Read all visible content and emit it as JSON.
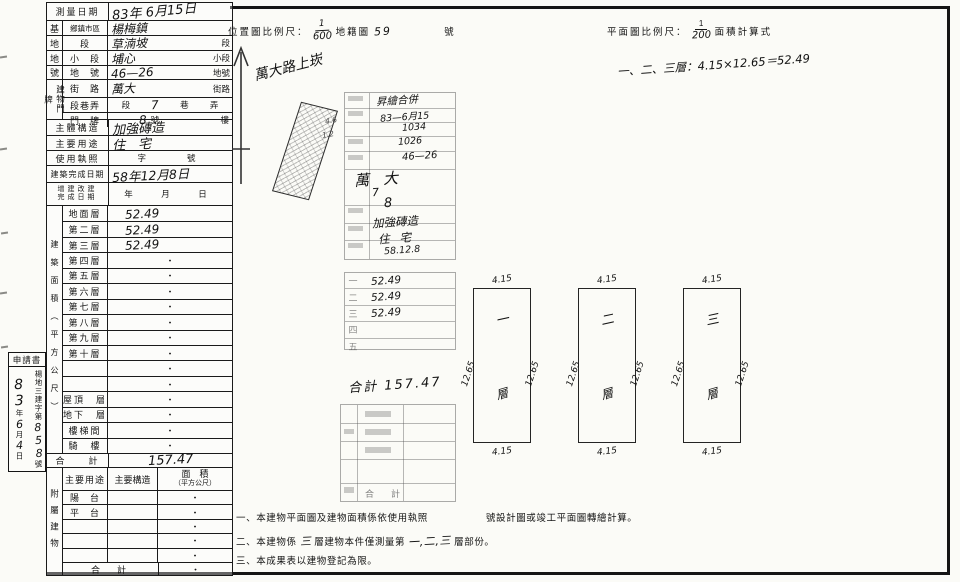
{
  "survey": {
    "r1": {
      "label": "測量日期",
      "value": "83年 6月15日"
    },
    "site": {
      "g1": "基",
      "g2": "地",
      "g3": "地",
      "g4": "號",
      "district": {
        "label": "鄉鎮市區",
        "value": "楊梅鎮"
      },
      "sec": {
        "label": "段",
        "value": "草湳坡",
        "suffix": "段"
      },
      "subsec": {
        "label": "小　段",
        "value": "埔心",
        "suffix": "小段"
      },
      "lotno": {
        "label": "地　號",
        "value": "46—26",
        "suffix": "地號"
      }
    },
    "addr": {
      "group": "建物門牌",
      "street": {
        "label": "街　路",
        "value": "萬大",
        "suffix": "街路"
      },
      "lane": {
        "label": "段巷弄",
        "p1": "段",
        "hw": "7",
        "p2": "巷",
        "p3": "弄"
      },
      "door": {
        "label": "門　牌",
        "hw": "8",
        "p1": "號",
        "p2": "樓"
      }
    },
    "structure": {
      "label": "主體構造",
      "value": "加強磚造"
    },
    "usage": {
      "label": "主要用途",
      "value": "住　宅"
    },
    "license": {
      "label": "使用執照",
      "value": "字　　號"
    },
    "completion": {
      "label": "建築完成日期",
      "value": "58年12月8日"
    },
    "alteration": {
      "label1": "增建改建",
      "label2": "完成日期",
      "value": "年　月　日"
    },
    "area_group": "建築面積（平方公尺）",
    "floors": [
      {
        "label": "地面層",
        "value": "52.49",
        "hw": true
      },
      {
        "label": "第二層",
        "value": "52.49",
        "hw": true
      },
      {
        "label": "第三層",
        "value": "52.49",
        "hw": true
      },
      {
        "label": "第四層",
        "value": "・"
      },
      {
        "label": "第五層",
        "value": "・"
      },
      {
        "label": "第六層",
        "value": "・"
      },
      {
        "label": "第七層",
        "value": "・"
      },
      {
        "label": "第八層",
        "value": "・"
      },
      {
        "label": "第九層",
        "value": "・"
      },
      {
        "label": "第十層",
        "value": "・"
      },
      {
        "label": "",
        "value": "・"
      },
      {
        "label": "",
        "value": "・"
      },
      {
        "label": "屋頂　層",
        "value": "・"
      },
      {
        "label": "地下　層",
        "value": "・"
      },
      {
        "label": "樓梯間",
        "value": "・"
      },
      {
        "label": "騎　樓",
        "value": "・"
      }
    ],
    "total": {
      "label": "合　　計",
      "value": "157.47"
    },
    "annex": {
      "group": "附屬建物",
      "header": {
        "usage": "主要用途",
        "structure": "主要構造",
        "area1": "面　積",
        "area2": "（平方公尺）"
      },
      "rows": [
        {
          "label": "陽　台",
          "value": "・"
        },
        {
          "label": "平　台",
          "value": "・"
        },
        {
          "label": "",
          "value": "・"
        },
        {
          "label": "",
          "value": "・"
        },
        {
          "label": "",
          "value": "・"
        }
      ],
      "total": {
        "label": "合　計",
        "value": "・"
      }
    }
  },
  "app": {
    "title": "申請書",
    "y": "83",
    "yu": "年",
    "m": "6",
    "mu": "月",
    "d": "4",
    "du": "日",
    "prefix": "楊地三建字第",
    "number": "858",
    "suffix": "號"
  },
  "loc": {
    "label": "位置圖比例尺：",
    "fnum": "1",
    "fden": "600",
    "map_label": "地籍圖",
    "sheet_no": "59",
    "no_suffix": "號"
  },
  "sketch": {
    "road_note": "萬大路上崁",
    "dim_a": "4.6",
    "dim_b": "1.2"
  },
  "planhdr": {
    "label": "平面圖比例尺：",
    "fnum": "1",
    "fden": "200",
    "calc_label": "面積計算式"
  },
  "formula": "一、二、三層：4.15×12.65＝52.49",
  "stamp": {
    "title_hw": "昇繪合併",
    "date": "83—6月15",
    "num1": "1034",
    "num2": "1026",
    "lot": "46—26",
    "street": "萬大",
    "lane": "7",
    "door": "8",
    "structure": "加強磚造",
    "usage": "住宅",
    "cdate": "58.12.8",
    "floor_rows": [
      {
        "no": "一",
        "area": "52.49",
        "hw": true
      },
      {
        "no": "二",
        "area": "52.49",
        "hw": true
      },
      {
        "no": "三",
        "area": "52.49",
        "hw": true
      },
      {
        "no": "四",
        "area": ""
      },
      {
        "no": "五",
        "area": ""
      }
    ],
    "total": "合計 157.47",
    "bottom_total": "合　計"
  },
  "plans": [
    {
      "floor": "一",
      "top": "4.15",
      "bottom": "4.15",
      "left": "12.65",
      "right": "12.65",
      "inner": "層"
    },
    {
      "floor": "二",
      "top": "4.15",
      "bottom": "4.15",
      "left": "12.65",
      "right": "12.65",
      "inner": "層"
    },
    {
      "floor": "三",
      "top": "4.15",
      "bottom": "4.15",
      "left": "12.65",
      "right": "12.65",
      "inner": "層"
    }
  ],
  "notes": {
    "n1a": "一、本建物平面圖及建物面積係依使用執照",
    "n1b": "號設計圖或竣工平面圖轉繪計算。",
    "n2a": "二、本建物係",
    "n2hw1": "三",
    "n2b": "層建物本件僅測量第",
    "n2hw2": "一,二,三",
    "n2c": "層部份。",
    "n3": "三、本成果表以建物登記為限。"
  }
}
